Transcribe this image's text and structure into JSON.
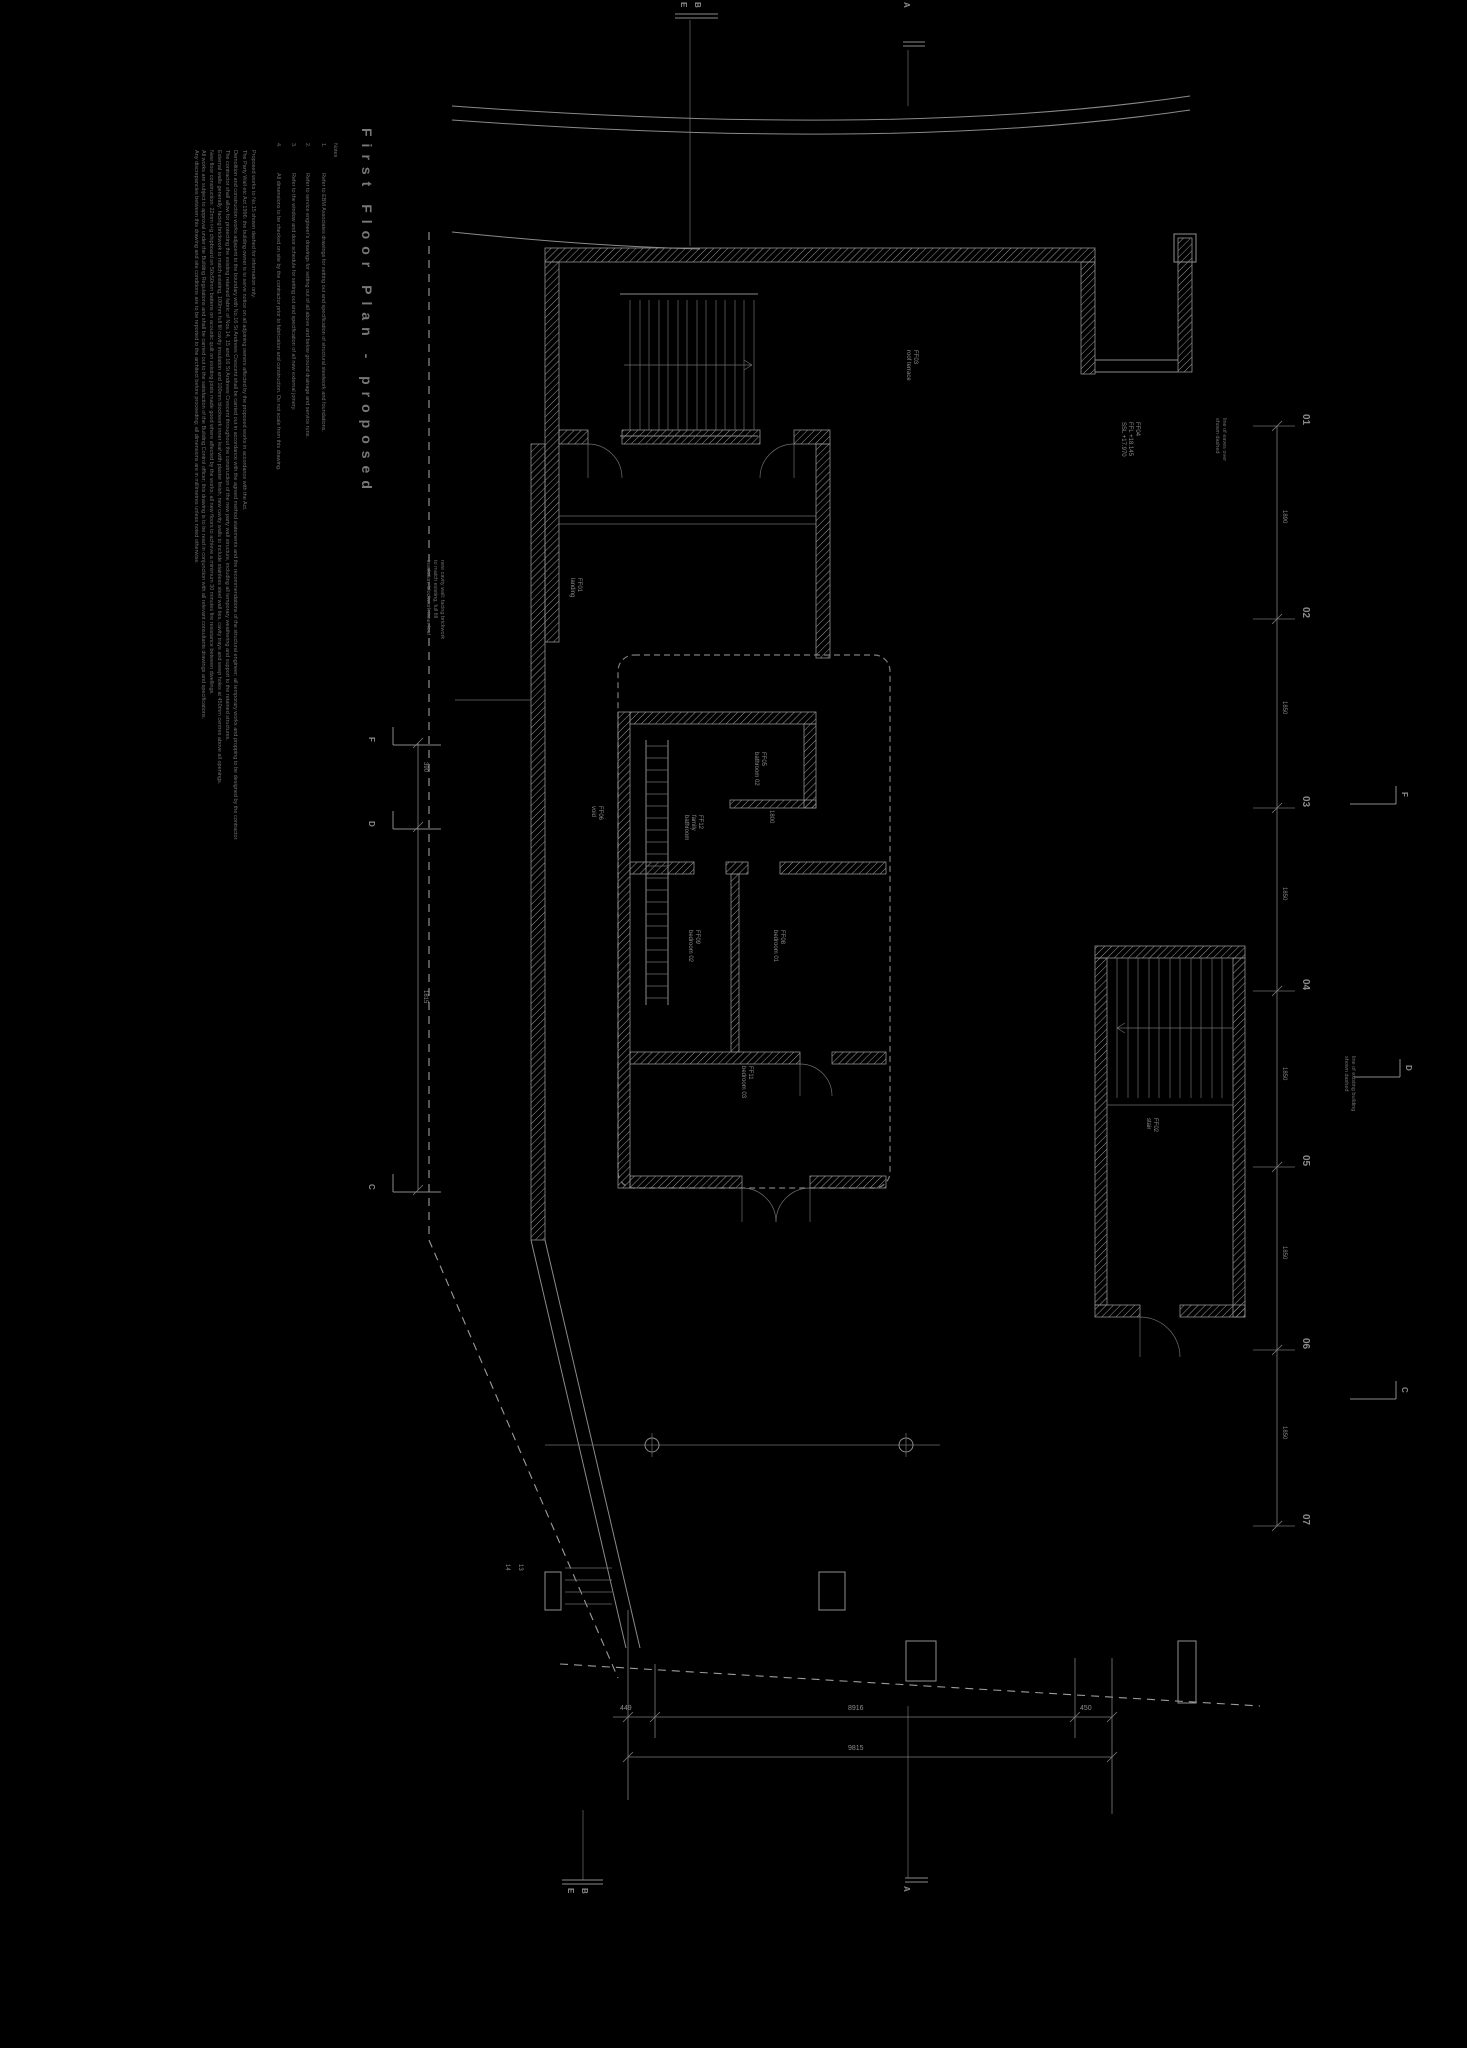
{
  "colors": {
    "background": "#000000",
    "linework": "#8a8a8a",
    "text": "#7a7a7a"
  },
  "title": {
    "text": "First Floor Plan - proposed"
  },
  "notes": {
    "heading": "Notes",
    "numbered": [
      {
        "num": "1.",
        "text": "Refer to EBM Associates drawings for setting out and specification of structural steelwork and foundations."
      },
      {
        "num": "2.",
        "text": "Refer to service engineer's drawings for setting out of all above and below ground drainage and service runs."
      },
      {
        "num": "3.",
        "text": "Refer to the window and door schedule for setting out and specification of all new external joinery."
      },
      {
        "num": "4.",
        "text": "All dimensions to be checked on site by the contractor prior to fabrication and construction. Do not scale from this drawing."
      }
    ],
    "paragraphs": [
      "Proposed works to No.15 shown dashed for information only.",
      "The Party Wall etc Act 1996: the building owner is to serve notice on all adjoining owners affected by the proposed works in accordance with the Act.",
      "Demolition and construction works adjacent to the boundary with No.16 St Andrews Crescent shall be carried out in accordance with the agreed method statements and the recommendations of the structural engineer; all temporary works and propping to be designed by the contractor.",
      "The contractor shall allow for protecting the existing retained fabric of Nos.14, 15 and 16 St Andrews Crescent throughout the construction of the new party wall structure, including all temporary weathering and support to the retained structures.",
      "External walls generally: facing brickwork to match existing, 100mm full fill cavity insulation and 100mm blockwork inner leaf with plaster finish; new cavity walls to include stainless steel wall ties, cavity trays and weep holes at 450mm centres above all openings.",
      "New floor construction: 22mm t+g chipboard on 50x50mm battens on acoustic quilt on existing joists made good where affected by the works; all new floors to achieve a minimum 30 minutes fire resistance between dwellings.",
      "All works are subject to approval under the Building Regulations and shall be carried out to the satisfaction of the Building Control officer; this drawing is to be read in conjunction with all relevant consultants drawings and specifications.",
      "Any discrepancies between this drawing and site conditions are to be reported to the architect before proceeding; all dimensions are in millimetres unless noted otherwise."
    ]
  },
  "grid": {
    "rows": [
      "01",
      "02",
      "03",
      "04",
      "05",
      "06",
      "07"
    ],
    "sections": {
      "top": [
        "E",
        "B",
        "A"
      ],
      "bottom": [
        "E",
        "B",
        "A"
      ],
      "left": [
        "F",
        "D",
        "C"
      ],
      "right": [
        "F",
        "D",
        "C"
      ]
    }
  },
  "dims": {
    "bottom": [
      "449",
      "8916",
      "450"
    ],
    "bottom_total": "9815",
    "right_chain": [
      "1890",
      "1850",
      "1850",
      "1850",
      "1850",
      "1850"
    ],
    "left_chain": [
      "390",
      "1815"
    ],
    "cluster": [
      "1800"
    ]
  },
  "rooms": [
    {
      "lines": [
        "FF01",
        "landing"
      ]
    },
    {
      "lines": [
        "FF05",
        "bathroom 02"
      ]
    },
    {
      "lines": [
        "FF12",
        "family",
        "bathroom"
      ]
    },
    {
      "lines": [
        "FF08",
        "bedroom 01"
      ]
    },
    {
      "lines": [
        "FF09",
        "bedroom 02"
      ]
    },
    {
      "lines": [
        "FF11",
        "bedroom 03"
      ]
    },
    {
      "lines": [
        "FF06",
        "void"
      ]
    },
    {
      "lines": [
        "FF02",
        "stair"
      ]
    },
    {
      "lines": [
        "FF03",
        "roof terrace"
      ]
    },
    {
      "lines": [
        "FF04",
        "FFL +18.145",
        "SSL +17.970"
      ]
    }
  ],
  "annotations": [
    {
      "lines": [
        "new cavity wall: facing brickwork",
        "to match existing, full fill",
        "insulation, blockwork inner leaf"
      ]
    },
    {
      "lines": [
        "line of existing building",
        "shown dashed"
      ]
    },
    {
      "lines": [
        "line of eaves over",
        "shown dashed"
      ]
    }
  ],
  "misc": {
    "stair_numbers": [
      "14",
      "13"
    ]
  }
}
